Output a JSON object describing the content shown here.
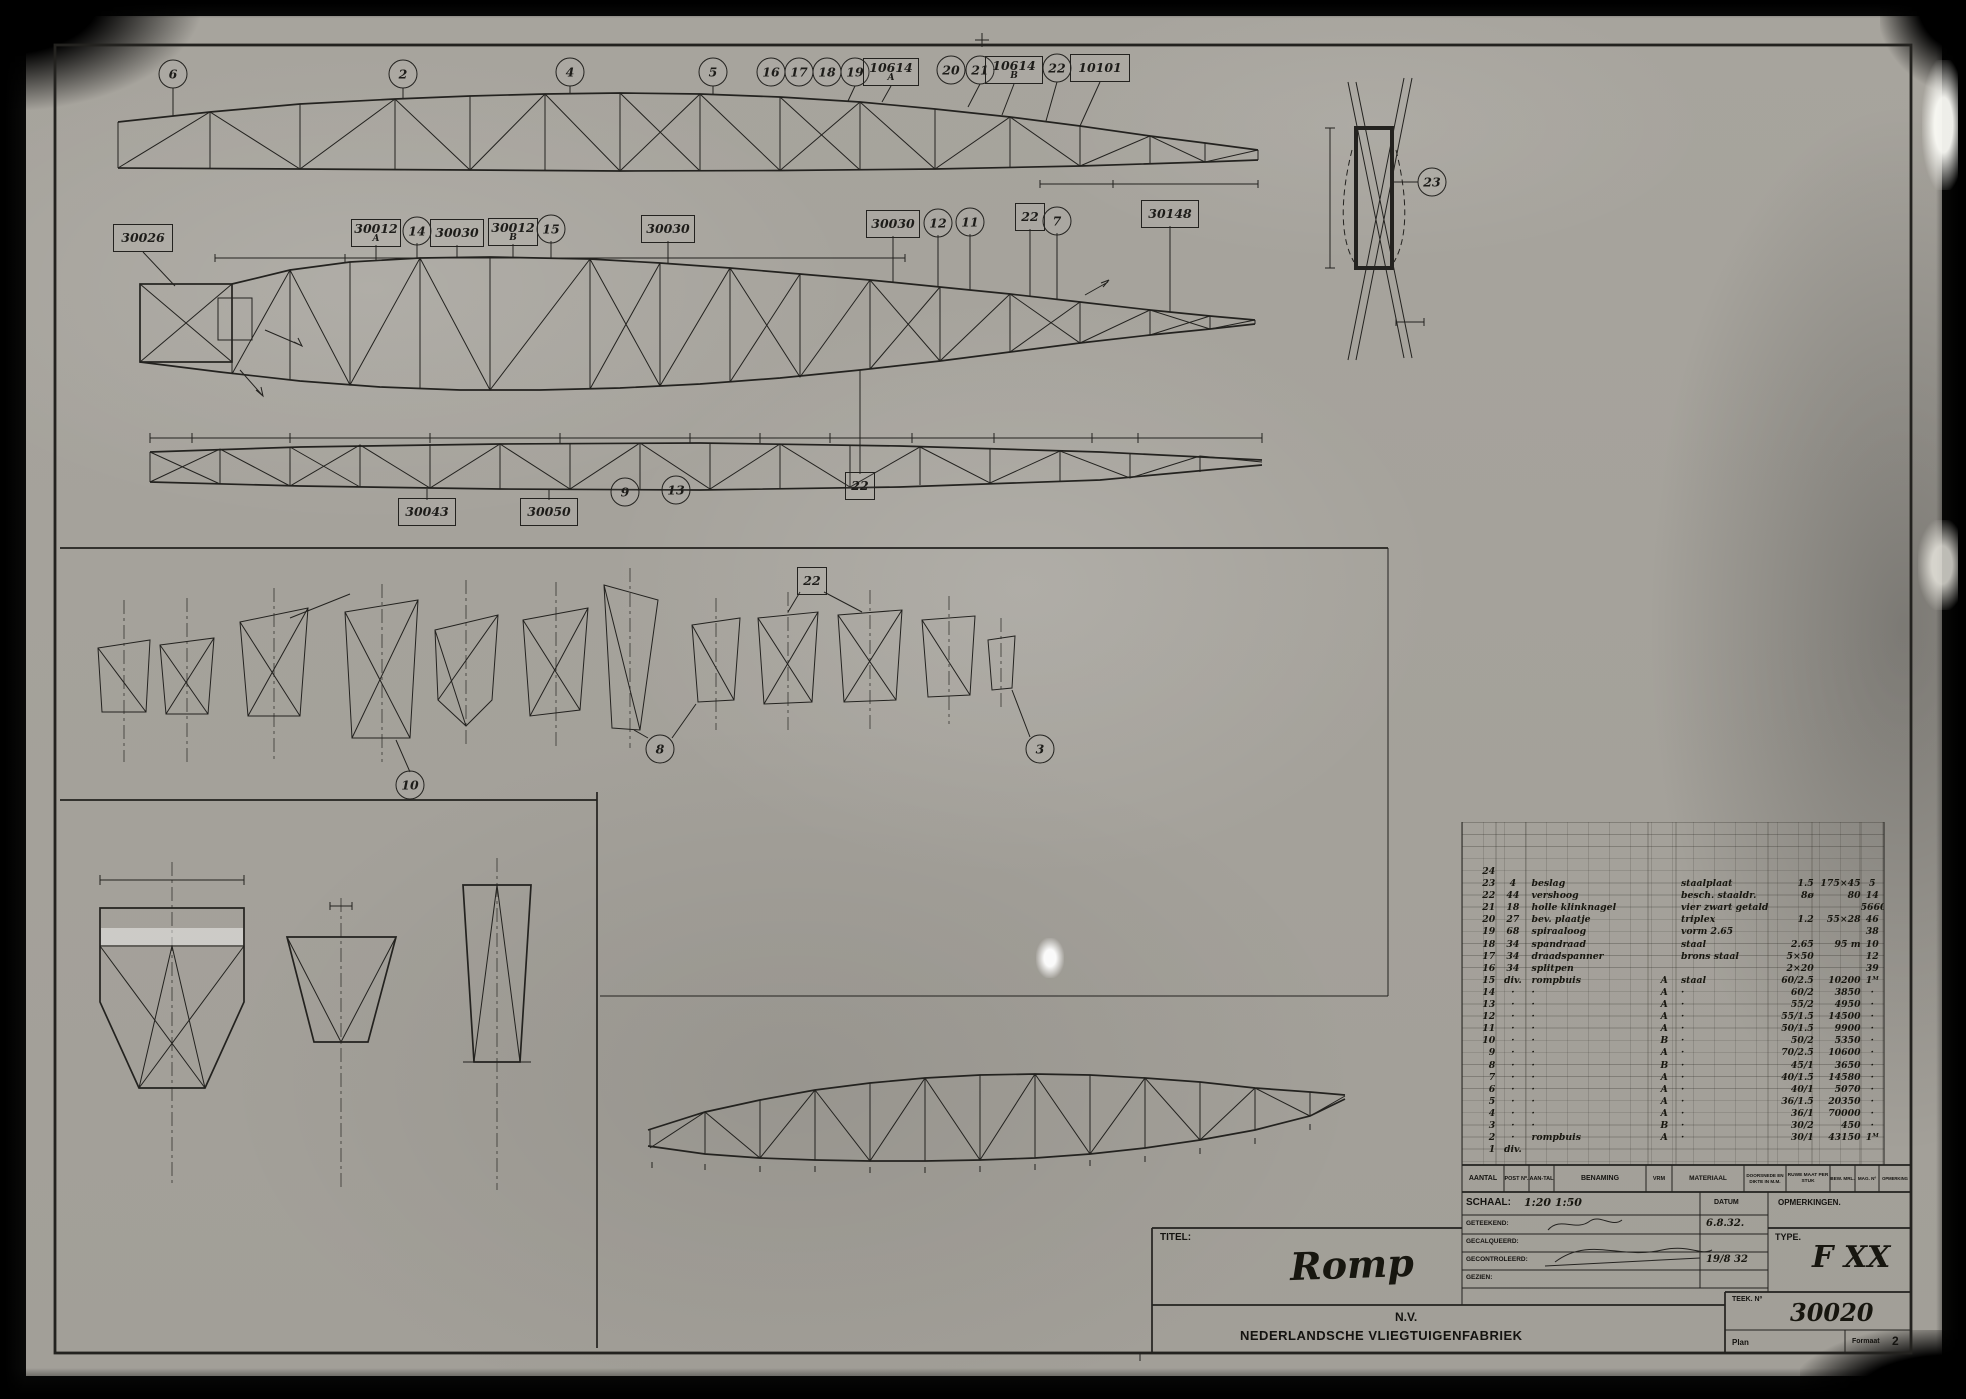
{
  "sheet": {
    "page_number": "2",
    "section_markers": {
      "a": "A",
      "b": "B",
      "c": "C",
      "d": "D"
    }
  },
  "callouts": [
    {
      "label": "6",
      "c": "circle",
      "x": 173,
      "y": 74
    },
    {
      "label": "2",
      "c": "circle",
      "x": 403,
      "y": 74
    },
    {
      "label": "4",
      "c": "circle",
      "x": 570,
      "y": 72
    },
    {
      "label": "5",
      "c": "circle",
      "x": 713,
      "y": 72
    },
    {
      "label": "16",
      "c": "circle",
      "x": 771,
      "y": 72
    },
    {
      "label": "17",
      "c": "circle",
      "x": 799,
      "y": 72
    },
    {
      "label": "18",
      "c": "circle",
      "x": 827,
      "y": 72
    },
    {
      "label": "19",
      "c": "circle",
      "x": 855,
      "y": 72
    },
    {
      "label": "10614",
      "sub": "A",
      "c": "box",
      "x": 891,
      "y": 72,
      "w": 50
    },
    {
      "label": "20",
      "c": "circle",
      "x": 951,
      "y": 70
    },
    {
      "label": "21",
      "c": "circle",
      "x": 980,
      "y": 70
    },
    {
      "label": "10614",
      "sub": "B",
      "c": "box",
      "x": 1014,
      "y": 70,
      "w": 52
    },
    {
      "label": "22",
      "c": "circle",
      "x": 1057,
      "y": 68
    },
    {
      "label": "10101",
      "c": "box",
      "x": 1100,
      "y": 68,
      "w": 54
    },
    {
      "label": "30026",
      "c": "box",
      "x": 143,
      "y": 238,
      "w": 54
    },
    {
      "label": "30012",
      "sub": "A",
      "c": "box",
      "x": 376,
      "y": 233,
      "w": 44
    },
    {
      "label": "14",
      "c": "circle",
      "x": 417,
      "y": 231
    },
    {
      "label": "30030",
      "c": "box",
      "x": 457,
      "y": 233,
      "w": 48
    },
    {
      "label": "30012",
      "sub": "B",
      "c": "box",
      "x": 513,
      "y": 232,
      "w": 44
    },
    {
      "label": "15",
      "c": "circle",
      "x": 551,
      "y": 229
    },
    {
      "label": "30030",
      "c": "box",
      "x": 668,
      "y": 229,
      "w": 48
    },
    {
      "label": "30030",
      "c": "box",
      "x": 893,
      "y": 224,
      "w": 48
    },
    {
      "label": "12",
      "c": "circle",
      "x": 938,
      "y": 223
    },
    {
      "label": "11",
      "c": "circle",
      "x": 970,
      "y": 222
    },
    {
      "label": "22",
      "c": "box",
      "x": 1030,
      "y": 217,
      "w": 24
    },
    {
      "label": "7",
      "c": "circle",
      "x": 1057,
      "y": 221
    },
    {
      "label": "30148",
      "c": "box",
      "x": 1170,
      "y": 214,
      "w": 52
    },
    {
      "label": "30043",
      "c": "box",
      "x": 427,
      "y": 512,
      "w": 52
    },
    {
      "label": "30050",
      "c": "box",
      "x": 549,
      "y": 512,
      "w": 52
    },
    {
      "label": "9",
      "c": "circle",
      "x": 625,
      "y": 492
    },
    {
      "label": "13",
      "c": "circle",
      "x": 676,
      "y": 490
    },
    {
      "label": "22",
      "c": "box",
      "x": 860,
      "y": 486,
      "w": 24
    },
    {
      "label": "22",
      "c": "box",
      "x": 812,
      "y": 581,
      "w": 24
    },
    {
      "label": "10",
      "c": "circle",
      "x": 410,
      "y": 785
    },
    {
      "label": "8",
      "c": "circle",
      "x": 660,
      "y": 749
    },
    {
      "label": "3",
      "c": "circle",
      "x": 1040,
      "y": 749
    },
    {
      "label": "23",
      "c": "circle",
      "x": 1432,
      "y": 182
    }
  ],
  "labels": [
    {
      "t": "1025",
      "x": 1060,
      "y": 177,
      "c": "dim"
    },
    {
      "t": "1600",
      "x": 1170,
      "y": 177,
      "c": "dim"
    },
    {
      "t": "1130",
      "x": 237,
      "y": 250,
      "c": "dim"
    },
    {
      "t": "1800",
      "x": 615,
      "y": 250,
      "c": "dim"
    },
    {
      "t": "30/1",
      "x": 295,
      "y": 130,
      "c": "dimv",
      "r": -75
    },
    {
      "t": "36/1",
      "x": 460,
      "y": 122,
      "c": "dimv",
      "r": -75
    },
    {
      "t": "40/1",
      "x": 608,
      "y": 120,
      "c": "dimv",
      "r": -75
    },
    {
      "t": "40/1.5",
      "x": 772,
      "y": 120,
      "c": "dimv",
      "r": -75
    },
    {
      "t": "36/1.5",
      "x": 930,
      "y": 128,
      "c": "dimv",
      "r": -75
    },
    {
      "t": "30/2",
      "x": 1068,
      "y": 140,
      "c": "dimv",
      "r": -75
    },
    {
      "t": "750",
      "x": 128,
      "y": 312,
      "c": "dimv",
      "r": -90
    },
    {
      "t": "620",
      "x": 243,
      "y": 310,
      "c": "dimv",
      "r": -90
    },
    {
      "t": "60/2.5",
      "x": 352,
      "y": 302,
      "c": "dimv",
      "r": -75
    },
    {
      "t": "55/2",
      "x": 422,
      "y": 300,
      "c": "dimv",
      "r": -75
    },
    {
      "t": "55/1.5",
      "x": 492,
      "y": 302,
      "c": "dimv",
      "r": -75
    },
    {
      "t": "50/1.5",
      "x": 562,
      "y": 304,
      "c": "dimv",
      "r": -75
    },
    {
      "t": "60/2",
      "x": 627,
      "y": 306,
      "c": "dimv",
      "r": -75
    },
    {
      "t": "70/2.5",
      "x": 697,
      "y": 308,
      "c": "dimv",
      "r": -75
    },
    {
      "t": "50/2",
      "x": 767,
      "y": 310,
      "c": "dimv",
      "r": -75
    },
    {
      "t": "45/1",
      "x": 837,
      "y": 312,
      "c": "dimv",
      "r": -75
    },
    {
      "t": "40/1.5",
      "x": 907,
      "y": 314,
      "c": "dimv",
      "r": -75
    },
    {
      "t": "40/1",
      "x": 977,
      "y": 316,
      "c": "dimv",
      "r": -75
    },
    {
      "t": "36/1.5",
      "x": 1047,
      "y": 318,
      "c": "dimv",
      "r": -75
    },
    {
      "t": "36/1",
      "x": 1117,
      "y": 320,
      "c": "dimv",
      "r": -75
    },
    {
      "t": "30/2",
      "x": 1187,
      "y": 322,
      "c": "dimv",
      "r": -75
    },
    {
      "t": "30/1",
      "x": 1240,
      "y": 322,
      "c": "dimv",
      "r": -75
    },
    {
      "t": "330",
      "x": 165,
      "y": 430,
      "c": "dim"
    },
    {
      "t": "1130",
      "x": 233,
      "y": 430,
      "c": "dim"
    },
    {
      "t": "1700",
      "x": 352,
      "y": 430,
      "c": "dim"
    },
    {
      "t": "1650",
      "x": 487,
      "y": 430,
      "c": "dim"
    },
    {
      "t": "1650",
      "x": 617,
      "y": 430,
      "c": "dim"
    },
    {
      "t": "730",
      "x": 718,
      "y": 430,
      "c": "dim"
    },
    {
      "t": "880",
      "x": 788,
      "y": 430,
      "c": "dim"
    },
    {
      "t": "1000",
      "x": 864,
      "y": 430,
      "c": "dim"
    },
    {
      "t": "1000",
      "x": 946,
      "y": 430,
      "c": "dim"
    },
    {
      "t": "1175",
      "x": 1036,
      "y": 430,
      "c": "dim"
    },
    {
      "t": "475",
      "x": 1108,
      "y": 430,
      "c": "dim"
    },
    {
      "t": "975",
      "x": 1192,
      "y": 430,
      "c": "dim"
    },
    {
      "t": "60/1.5",
      "x": 432,
      "y": 466,
      "c": "dim"
    },
    {
      "t": "70/1.5",
      "x": 562,
      "y": 465,
      "c": "dim"
    },
    {
      "t": "I",
      "x": 146,
      "y": 503,
      "c": "rn"
    },
    {
      "t": "II",
      "x": 215,
      "y": 503,
      "c": "rn"
    },
    {
      "t": "Iᴬ",
      "x": 300,
      "y": 505,
      "c": "rn"
    },
    {
      "t": "II",
      "x": 473,
      "y": 506,
      "c": "rn"
    },
    {
      "t": "II",
      "x": 762,
      "y": 503,
      "c": "rn"
    },
    {
      "t": "III",
      "x": 884,
      "y": 503,
      "c": "rn"
    },
    {
      "t": "II",
      "x": 966,
      "y": 503,
      "c": "rn"
    },
    {
      "t": "I",
      "x": 1046,
      "y": 503,
      "c": "rn"
    },
    {
      "t": "II",
      "x": 1134,
      "y": 503,
      "c": "rn"
    },
    {
      "t": "IIᴬ",
      "x": 1186,
      "y": 502,
      "c": "rn"
    },
    {
      "t": "Transportbeslag",
      "x": 420,
      "y": 494,
      "c": "dim"
    },
    {
      "t": "Roerbeslagen",
      "x": 552,
      "y": 494,
      "c": "dim"
    },
    {
      "t": "A",
      "x": 305,
      "y": 336,
      "c": "mk"
    },
    {
      "t": "B",
      "x": 266,
      "y": 394,
      "c": "mk"
    },
    {
      "t": "C",
      "x": 1114,
      "y": 276,
      "c": "mk"
    },
    {
      "t": "B",
      "x": 1124,
      "y": 536,
      "c": "mk"
    },
    {
      "t": "C",
      "x": 580,
      "y": 789,
      "c": "mk"
    },
    {
      "t": "D",
      "x": 1398,
      "y": 984,
      "c": "mk"
    },
    {
      "t": "bijkleppen",
      "x": 1436,
      "y": 220,
      "c": "noteu"
    },
    {
      "t": "170",
      "x": 1322,
      "y": 196,
      "c": "dimv",
      "r": -90
    },
    {
      "t": "40",
      "x": 1408,
      "y": 328,
      "c": "dim"
    },
    {
      "t": "Punt „D″",
      "x": 1410,
      "y": 376,
      "c": "script"
    },
    {
      "t": "aan onder en bovenkant buis",
      "x": 1408,
      "y": 404,
      "c": "note"
    },
    {
      "t": "Diagonalen na het lasschen van",
      "x": 302,
      "y": 579,
      "c": "noteu"
    },
    {
      "t": "dwarsbalken inzetten",
      "x": 300,
      "y": 593,
      "c": "noteu"
    },
    {
      "t": "I",
      "x": 124,
      "y": 757,
      "c": "rn"
    },
    {
      "t": "I",
      "x": 187,
      "y": 757,
      "c": "rn"
    },
    {
      "t": "I",
      "x": 274,
      "y": 757,
      "c": "rn"
    },
    {
      "t": "II",
      "x": 382,
      "y": 757,
      "c": "rn"
    },
    {
      "t": "I",
      "x": 466,
      "y": 757,
      "c": "rn"
    },
    {
      "t": "II",
      "x": 556,
      "y": 757,
      "c": "rn"
    },
    {
      "t": "III",
      "x": 630,
      "y": 757,
      "c": "rn"
    },
    {
      "t": "III",
      "x": 716,
      "y": 757,
      "c": "rn"
    },
    {
      "t": "IX",
      "x": 788,
      "y": 757,
      "c": "rn"
    },
    {
      "t": "I",
      "x": 870,
      "y": 757,
      "c": "rn"
    },
    {
      "t": "X",
      "x": 949,
      "y": 757,
      "c": "rn"
    },
    {
      "t": "1160",
      "x": 164,
      "y": 873,
      "c": "dim"
    },
    {
      "t": "30",
      "x": 336,
      "y": 896,
      "c": "dim"
    },
    {
      "t": "64/1.5",
      "x": 198,
      "y": 960,
      "c": "dimv",
      "r": -62
    },
    {
      "t": "34/1.5",
      "x": 145,
      "y": 1012,
      "c": "dimv",
      "r": 62
    },
    {
      "t": "24/1",
      "x": 222,
      "y": 1012,
      "c": "dimv",
      "r": -62
    },
    {
      "t": "34/1.5",
      "x": 318,
      "y": 980,
      "c": "dimv",
      "r": -68
    },
    {
      "t": "24/1.5",
      "x": 362,
      "y": 980,
      "c": "dimv",
      "r": 68
    },
    {
      "t": "40/1",
      "x": 504,
      "y": 938,
      "c": "dimv",
      "r": -82
    },
    {
      "t": "Spant volg. Pijl „A″",
      "x": 172,
      "y": 1243,
      "c": "big"
    },
    {
      "t": "Spant volg. Pijl „B″",
      "x": 340,
      "y": 1240,
      "c": "big"
    },
    {
      "t": "Spant volg. Pijl „C″",
      "x": 505,
      "y": 1247,
      "c": "big"
    },
    {
      "t": "1030",
      "x": 726,
      "y": 1088,
      "c": "dim"
    },
    {
      "t": "1050",
      "x": 836,
      "y": 1074,
      "c": "dim"
    },
    {
      "t": "1000",
      "x": 946,
      "y": 1068,
      "c": "dim"
    },
    {
      "t": "1000",
      "x": 1056,
      "y": 1066,
      "c": "dim"
    },
    {
      "t": "1175",
      "x": 1166,
      "y": 1072,
      "c": "dim"
    },
    {
      "t": "I",
      "x": 652,
      "y": 1176,
      "c": "rn"
    },
    {
      "t": "Iᴬ",
      "x": 678,
      "y": 1176,
      "c": "rn"
    },
    {
      "t": "I",
      "x": 712,
      "y": 1176,
      "c": "rn"
    },
    {
      "t": "II",
      "x": 758,
      "y": 1176,
      "c": "rn"
    },
    {
      "t": "II",
      "x": 812,
      "y": 1176,
      "c": "rn"
    },
    {
      "t": "III",
      "x": 868,
      "y": 1176,
      "c": "rn"
    },
    {
      "t": "II",
      "x": 924,
      "y": 1176,
      "c": "rn"
    },
    {
      "t": "II",
      "x": 980,
      "y": 1176,
      "c": "rn"
    },
    {
      "t": "II",
      "x": 1038,
      "y": 1176,
      "c": "rn"
    },
    {
      "t": "II",
      "x": 1152,
      "y": 1176,
      "c": "rn"
    },
    {
      "t": "II",
      "x": 1192,
      "y": 1176,
      "c": "rn"
    },
    {
      "t": "II",
      "x": 1232,
      "y": 1176,
      "c": "rn"
    },
    {
      "t": "I",
      "x": 1270,
      "y": 1176,
      "c": "rn"
    },
    {
      "t": "II",
      "x": 1310,
      "y": 1176,
      "c": "rn"
    },
    {
      "t": "IIᴬ",
      "x": 1350,
      "y": 1175,
      "c": "rn"
    },
    {
      "t": "dun getrokkende diagonalen zijn hulpdiagonalen",
      "x": 905,
      "y": 1207,
      "c": "note"
    },
    {
      "t": "Zijwanden van romp in een plat vlak uitgeslagen.",
      "x": 800,
      "y": 1298,
      "c": "big"
    },
    {
      "t": "2",
      "x": 1900,
      "y": 30,
      "c": "pg"
    }
  ],
  "parts_table": {
    "headers": [
      "AANTAL",
      "POST Nº.",
      "AAN-TAL",
      "BENAMING",
      "VRM",
      "MATERIAAL",
      "DOORSNEDE EN DIKTE IN M.M.",
      "RUWE MAAT PER STUK",
      "BEW. MRL.",
      "MAG. Nº",
      "OPMERKING"
    ],
    "rows": [
      [
        "24",
        "",
        "",
        "",
        "",
        "",
        "",
        ""
      ],
      [
        "23",
        "4",
        "beslag",
        "",
        "staalplaat",
        "1.5",
        "175×45",
        "5"
      ],
      [
        "22",
        "44",
        "vershoog",
        "",
        "besch. staaldr.",
        "8ø",
        "80",
        "14"
      ],
      [
        "21",
        "18",
        "holle klinknagel",
        "",
        "vier zwart getald",
        "",
        "",
        "5660"
      ],
      [
        "20",
        "27",
        "bev. plaatje",
        "",
        "triplex",
        "1.2",
        "55×28",
        "46"
      ],
      [
        "19",
        "68",
        "spiraaloog",
        "",
        "vorm 2.65",
        "",
        "",
        "38"
      ],
      [
        "18",
        "34",
        "spandraad",
        "",
        "staal",
        "2.65",
        "95 m",
        "10"
      ],
      [
        "17",
        "34",
        "draadspanner",
        "",
        "brons staal",
        "5×50",
        "",
        "12"
      ],
      [
        "16",
        "34",
        "splitpen",
        "",
        "",
        "2×20",
        "",
        "39"
      ],
      [
        "15",
        "div.",
        "rompbuis",
        "A",
        "staal",
        "60/2.5",
        "10200",
        "1ᴹ"
      ],
      [
        "14",
        "·",
        "·",
        "A",
        "·",
        "60/2",
        "3850",
        "·"
      ],
      [
        "13",
        "·",
        "·",
        "A",
        "·",
        "55/2",
        "4950",
        "·"
      ],
      [
        "12",
        "·",
        "·",
        "A",
        "·",
        "55/1.5",
        "14500",
        "·"
      ],
      [
        "11",
        "·",
        "·",
        "A",
        "·",
        "50/1.5",
        "9900",
        "·"
      ],
      [
        "10",
        "·",
        "·",
        "B",
        "·",
        "50/2",
        "5350",
        "·"
      ],
      [
        "9",
        "·",
        "·",
        "A",
        "·",
        "70/2.5",
        "10600",
        "·"
      ],
      [
        "8",
        "·",
        "·",
        "B",
        "·",
        "45/1",
        "3650",
        "·"
      ],
      [
        "7",
        "·",
        "·",
        "A",
        "·",
        "40/1.5",
        "14580",
        "·"
      ],
      [
        "6",
        "·",
        "·",
        "A",
        "·",
        "40/1",
        "5070",
        "·"
      ],
      [
        "5",
        "·",
        "·",
        "A",
        "·",
        "36/1.5",
        "20350",
        "·"
      ],
      [
        "4",
        "·",
        "·",
        "A",
        "·",
        "36/1",
        "70000",
        "·"
      ],
      [
        "3",
        "·",
        "·",
        "B",
        "·",
        "30/2",
        "450",
        "·"
      ],
      [
        "2",
        "·",
        "rompbuis",
        "A",
        "·",
        "30/1",
        "43150",
        "1ᴹ"
      ],
      [
        "1",
        "div.",
        "",
        "",
        "",
        "",
        "",
        ""
      ]
    ]
  },
  "title_block": {
    "schaal_label": "SCHAAL:",
    "schaal_value": "1:20   1:50",
    "datum_label": "DATUM",
    "opmerkingen_label": "OPMERKINGEN.",
    "geteekend_label": "GETEEKEND:",
    "geteekend_date": "6.8.32.",
    "gecalqueerd_label": "GECALQUEERD:",
    "gecontroleerd_label": "GECONTROLEERD:",
    "gecontroleerd_date": "19/8 32",
    "gezien_label": "GEZIEN:",
    "titel_label": "TITEL:",
    "titel_value": "Romp",
    "company_line1": "N.V.",
    "company_line2": "NEDERLANDSCHE VLIEGTUIGENFABRIEK",
    "type_label": "TYPE.",
    "type_value": "F XX",
    "teek_label": "TEEK. Nº",
    "teek_value": "30020",
    "plan_label": "Plan",
    "formaat_label": "Formaat",
    "formaat_value": "2"
  }
}
